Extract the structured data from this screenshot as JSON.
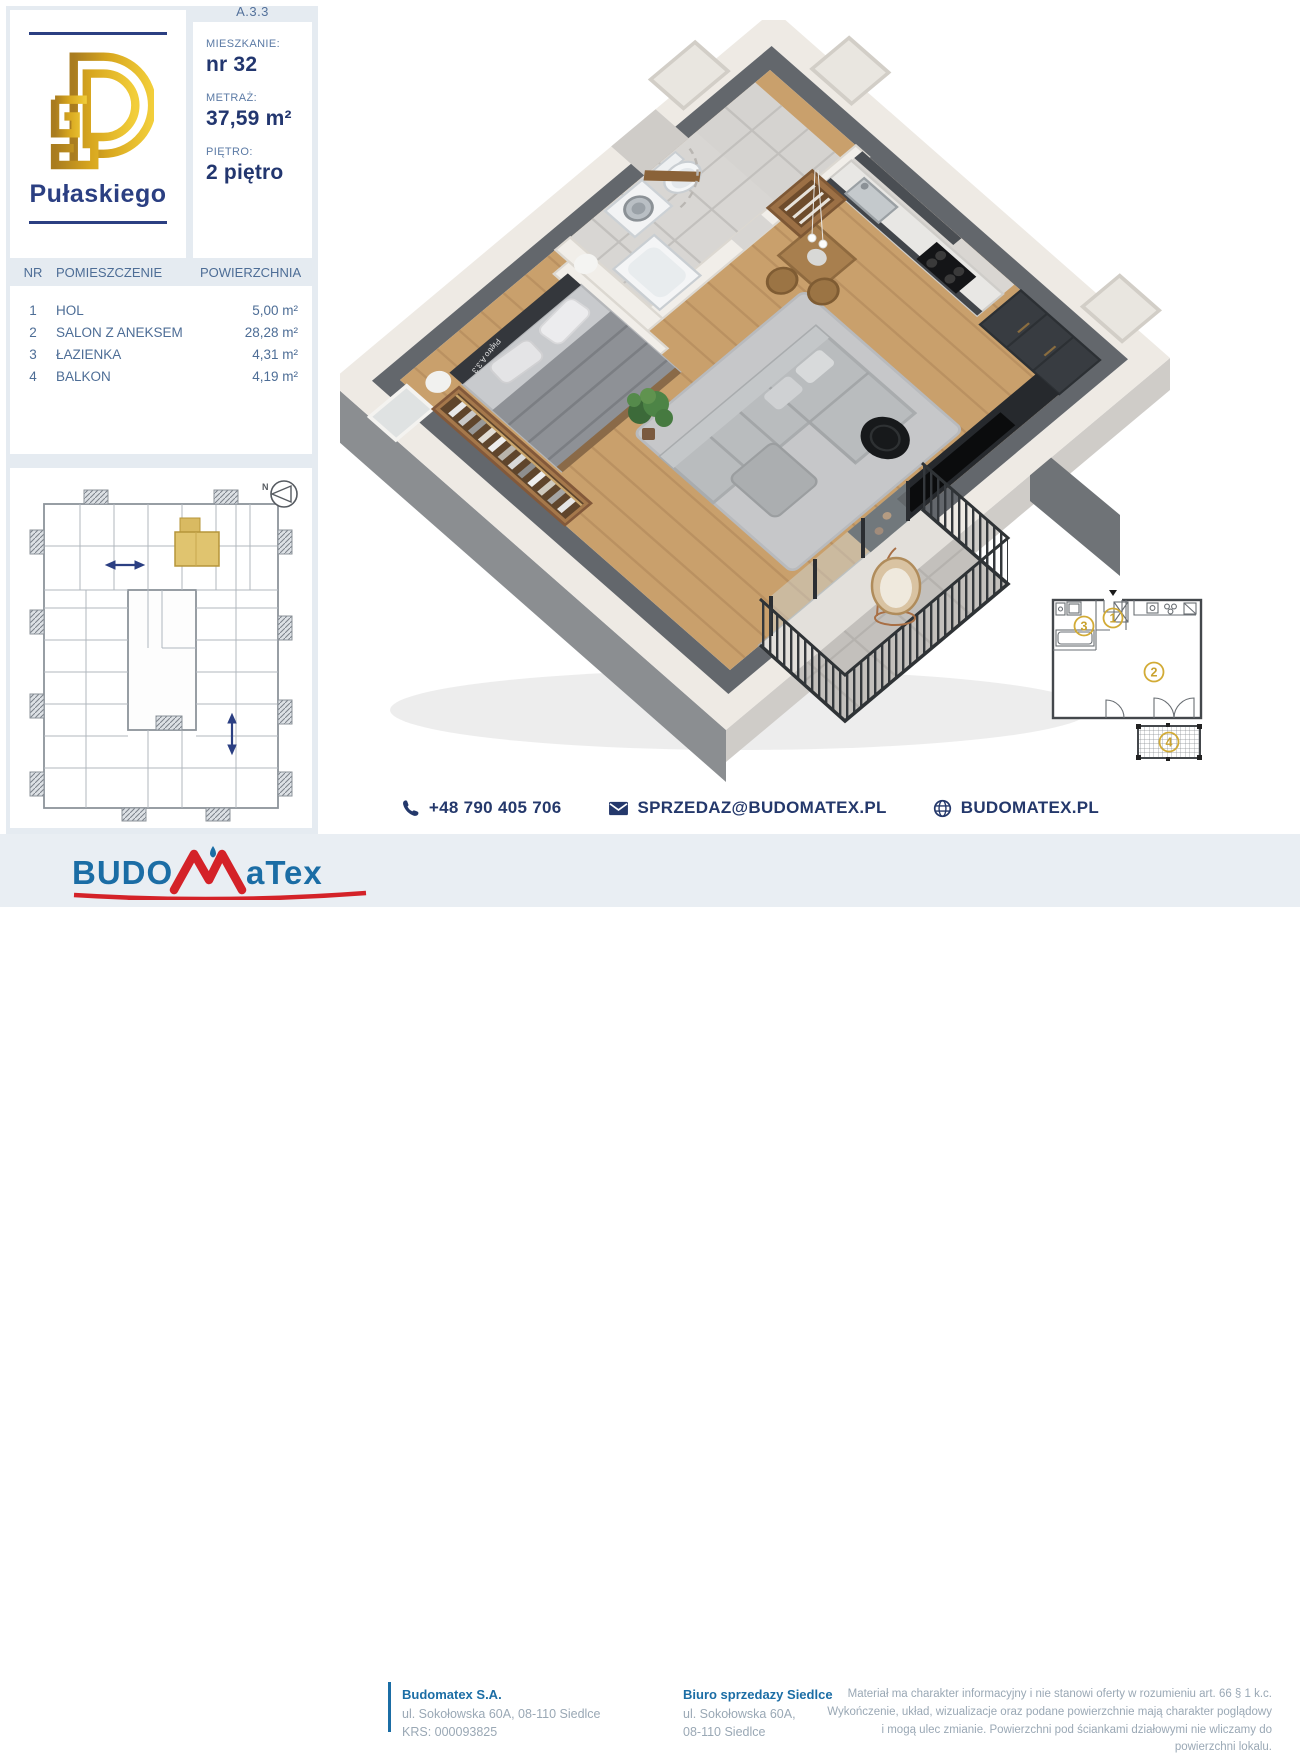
{
  "unit_code": "A.3.3",
  "project": {
    "name": "Pułaskiego",
    "logo_monogram": "P"
  },
  "details": {
    "apartment_label": "MIESZKANIE:",
    "apartment_value": "nr 32",
    "area_label": "METRAŻ:",
    "area_value": "37,59 m²",
    "floor_label": "PIĘTRO:",
    "floor_value": "2 piętro"
  },
  "rooms_table": {
    "headers": [
      "NR",
      "POMIESZCZENIE",
      "POWIERZCHNIA"
    ],
    "rows": [
      {
        "nr": "1",
        "name": "HOL",
        "area": "5,00 m²"
      },
      {
        "nr": "2",
        "name": "SALON Z ANEKSEM",
        "area": "28,28 m²"
      },
      {
        "nr": "3",
        "name": "ŁAZIENKA",
        "area": "4,31 m²"
      },
      {
        "nr": "4",
        "name": "BALKON",
        "area": "4,19 m²"
      }
    ]
  },
  "site_plan": {
    "compass_letter": "N"
  },
  "mini_plan": {
    "labels": [
      "1",
      "2",
      "3",
      "4"
    ]
  },
  "render_watermark": "Piętro A.3.3",
  "contact": {
    "phone": "+48 790 405 706",
    "email": "SPRZEDAZ@BUDOMATEX.PL",
    "website": "BUDOMATEX.PL"
  },
  "footer": {
    "logo_text_1": "BUDO",
    "logo_text_2": "aTex",
    "company": {
      "name": "Budomatex S.A.",
      "address": "ul. Sokołowska 60A, 08-110 Siedlce",
      "krs": "KRS: 000093825"
    },
    "office": {
      "name": "Biuro sprzedazy Siedlce",
      "address_line1": "ul. Sokołowska 60A,",
      "address_line2": "08-110 Siedlce"
    },
    "disclaimer": "Materiał ma charakter informacyjny i nie stanowi oferty w rozumieniu art. 66 § 1 k.c. Wykończenie, układ, wizualizacje oraz podane powierzchnie mają charakter poglądowy i mogą ulec zmianie. Powierzchni pod ściankami działowymi nie wliczamy do powierzchni lokalu."
  },
  "colors": {
    "navy": "#2b3f82",
    "steel_blue": "#53719b",
    "gold": "#d4af37",
    "highlight_gold": "#e0c46f",
    "brand_blue": "#1b6da5",
    "brand_red": "#d42228",
    "panel_bg": "#e5ebf1"
  }
}
